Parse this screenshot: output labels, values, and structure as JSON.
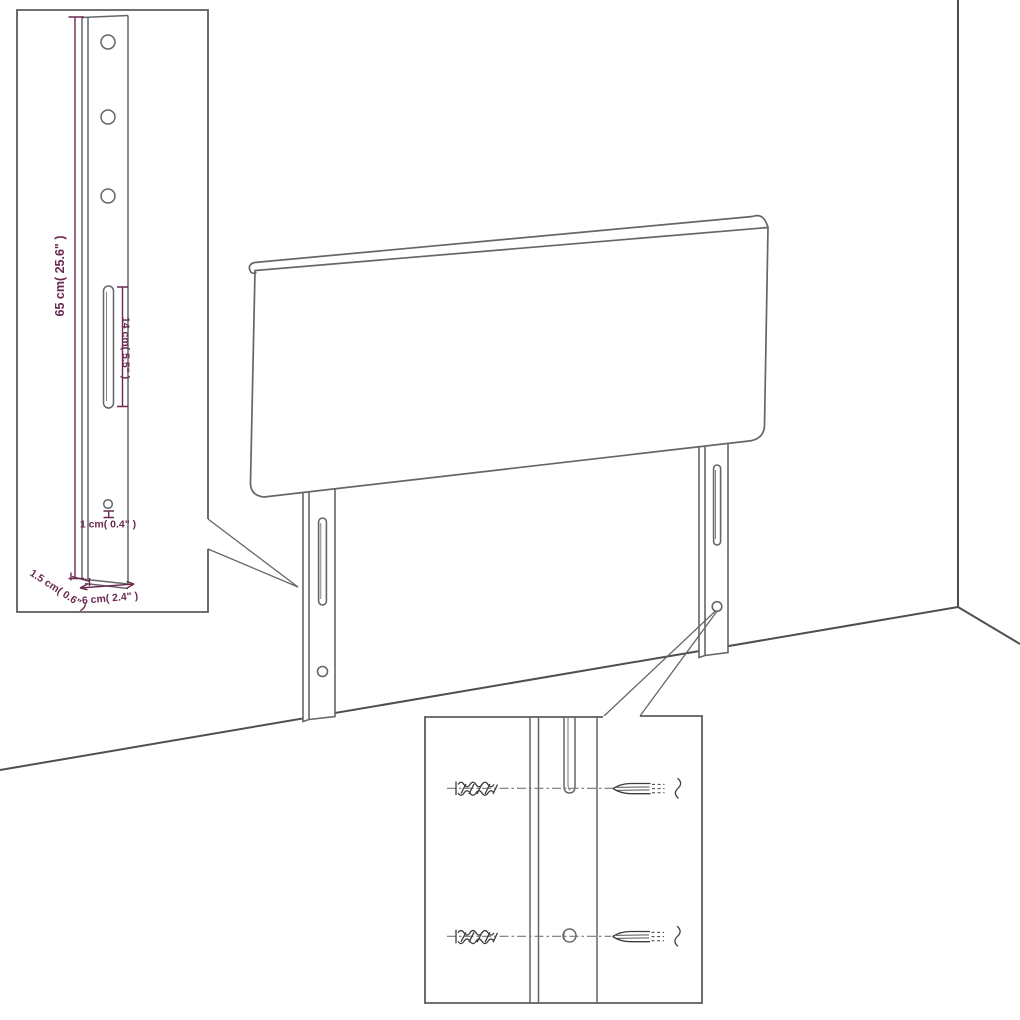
{
  "figure": {
    "colors": {
      "background": "#ffffff",
      "drawing_line": "#63666a",
      "wall_line": "#4f4f4f",
      "dimension_annotation": "#6b2950",
      "hardware_icon": "#3d3d3d"
    },
    "icons": [
      "wall-plug-icon",
      "screw-icon"
    ]
  },
  "dimensions": {
    "post_height": "65 cm( 25.6\" )",
    "slot_length": "14 cm( 5.5\" )",
    "hole_diameter": "1 cm( 0.4\" )",
    "post_thickness": "1.5 cm( 0.6\" )",
    "post_width": "6 cm( 2.4\" )"
  }
}
